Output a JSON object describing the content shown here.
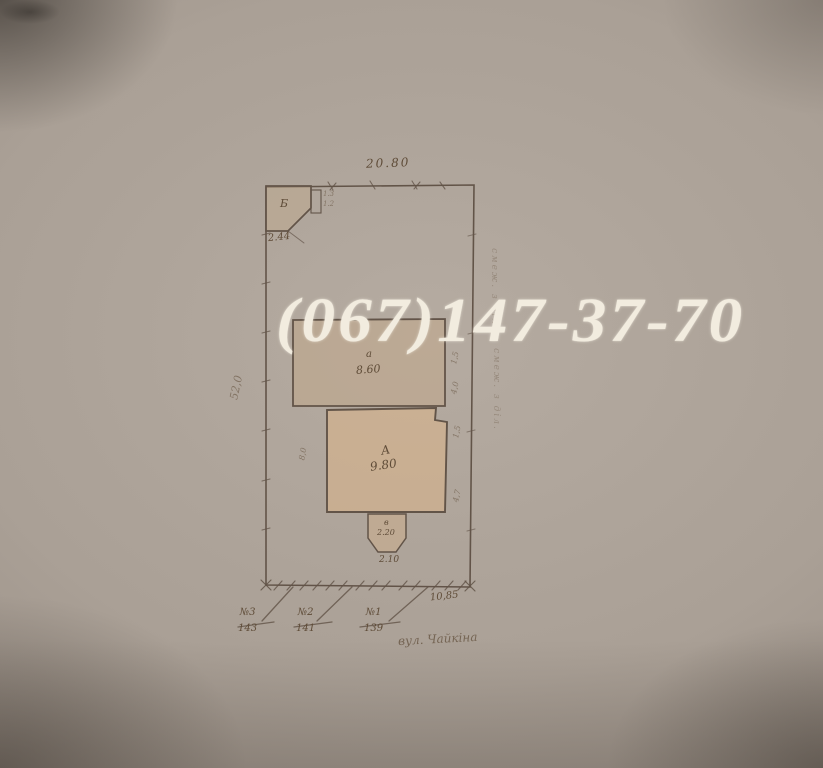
{
  "photo": {
    "background_hex": "#aaa096",
    "line_hex": "#55463a"
  },
  "watermark": {
    "text": "(067)147-37-70",
    "color_hex": "#f2ecdf"
  },
  "plan": {
    "top_dimension": "20.80",
    "left_dimension": "52,0",
    "bottom_right_dimension": "10,85",
    "buildings": {
      "shed": {
        "letter": "Б",
        "below": "2.44",
        "side_top": "1.3",
        "side_bottom": "1.2"
      },
      "annex": {
        "letter": "а",
        "area": "8.60"
      },
      "house": {
        "letter": "А",
        "area": "9.80"
      },
      "porch": {
        "letter": "в",
        "area": "2.20",
        "below": "2.10"
      }
    },
    "side_dimensions": {
      "house_left": "8,0",
      "annex_right_top": "1,5",
      "annex_right_bottom": "4,0",
      "house_right_top": "1,5",
      "house_right_bottom": "4,7"
    },
    "address_marks": [
      {
        "number": "№3",
        "house": "143"
      },
      {
        "number": "№2",
        "house": "141"
      },
      {
        "number": "№1",
        "house": "139"
      }
    ],
    "street_label": "вул. Чайкіна",
    "margin_notes": {
      "upper": "смеж. з діл.",
      "lower": "смеж. з діл."
    }
  }
}
